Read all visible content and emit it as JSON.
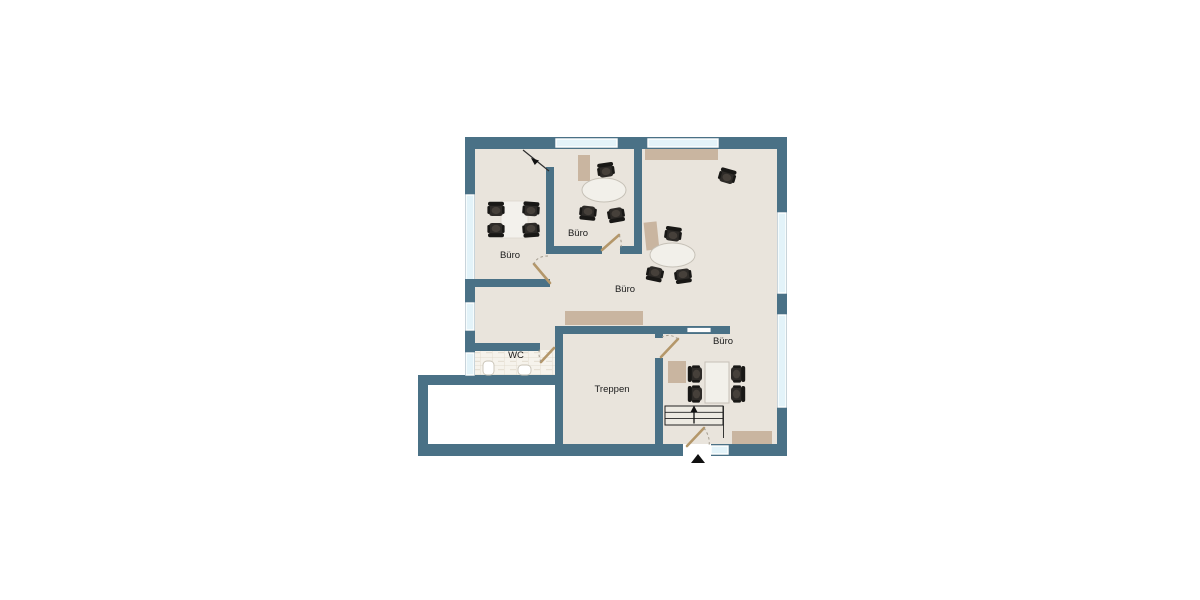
{
  "floorplan": {
    "rooms": [
      {
        "id": "buero-top-left",
        "label": "Büro"
      },
      {
        "id": "buero-top-middle",
        "label": "Büro"
      },
      {
        "id": "buero-main",
        "label": "Büro"
      },
      {
        "id": "buero-bottom-right",
        "label": "Büro"
      },
      {
        "id": "wc",
        "label": "WC"
      },
      {
        "id": "treppen",
        "label": "Treppen"
      }
    ],
    "colors": {
      "wall": "#4a7186",
      "floor": "#e9e4dc",
      "window_glass": "#e3f3f9",
      "furniture": "#c9b5a0",
      "table": "#f2f0ea",
      "chair": "#2e2b28",
      "door_leaf": "#b4976a",
      "annex_floor": "#ffffff",
      "wc_tile": "#f6f3ec"
    },
    "symbols": {
      "chair": "office-chair",
      "oval_table": "oval-table",
      "rect_table": "rect-table",
      "sideboard": "sideboard",
      "cabinet": "cabinet",
      "sink": "wc-sink",
      "toilet": "wc-toilet",
      "stairs_direction": "up",
      "entrance_marker": "triangle-up"
    }
  }
}
